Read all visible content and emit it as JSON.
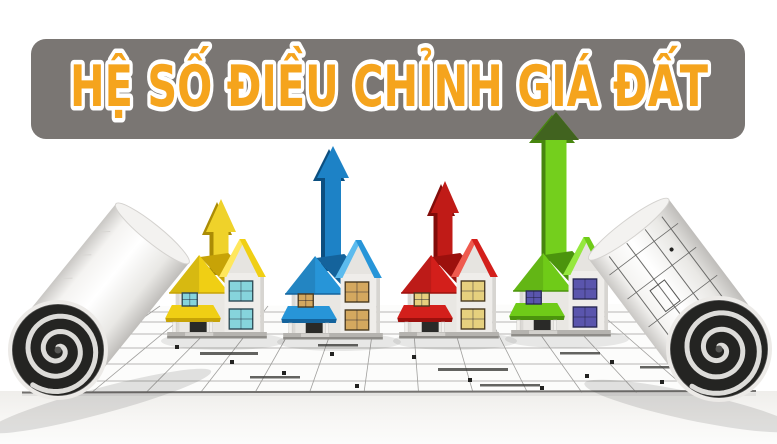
{
  "banner": {
    "title": "HỆ SỐ ĐIỀU CHỈNH GIÁ ĐẤT",
    "bg_color": "#7a7673",
    "title_color": "#f5a41d",
    "title_outline_color": "#ffffff",
    "x": 31,
    "y": 39,
    "width": 714,
    "height": 100,
    "radius": 15,
    "text_center_x": 389,
    "text_baseline_y": 106,
    "font_size": 57,
    "text_length": 638
  },
  "illustration": {
    "palette": {
      "wall": "#e9e7e3",
      "wall_right": "#efedea",
      "wall_gable": "#e6e4e0",
      "wall_side": "#d7d5d1",
      "door": "#2a2a28",
      "post": "#f2f0ed",
      "base_top": "#b5b3af",
      "base_edge": "#8e8c88",
      "step": "#d2d0cc",
      "plan_line": "#a09f9d",
      "plan_dark": "#3c3c3a",
      "paper_edge": "#757371",
      "roll_face": "#242422",
      "roll_spiral": "#dddcd9",
      "roll_rim": "#eceae7",
      "ground_top": "#efeeeb",
      "ground_bottom": "#fcfcfb"
    },
    "floor": {
      "back_y": 306,
      "front_y": 392.5,
      "back_x1": 150,
      "back_x2": 635,
      "front_x1": 22,
      "front_x2": 756,
      "v_lines_from": 160,
      "v_lines_to": 632,
      "v_lines_step": 36,
      "h_lines": [
        312,
        322,
        334,
        348,
        364,
        381
      ],
      "wall_segments": [
        [
          200,
          352,
          58,
          3
        ],
        [
          318,
          344,
          40,
          2.5
        ],
        [
          438,
          368,
          70,
          3
        ],
        [
          560,
          352,
          40,
          2.5
        ],
        [
          250,
          376,
          50,
          2.5
        ],
        [
          480,
          384,
          60,
          2.5
        ],
        [
          640,
          366,
          45,
          2.5
        ]
      ],
      "dots": [
        [
          230,
          360
        ],
        [
          282,
          371
        ],
        [
          355,
          384
        ],
        [
          412,
          355
        ],
        [
          468,
          378
        ],
        [
          540,
          386
        ],
        [
          610,
          360
        ],
        [
          660,
          380
        ],
        [
          175,
          345
        ],
        [
          700,
          371
        ],
        [
          330,
          352
        ],
        [
          585,
          374
        ]
      ]
    },
    "houses": [
      {
        "id": "yellow",
        "x": 170,
        "base_y": 339,
        "w": 94,
        "roof": "#f0cf14",
        "roof_dark": "#c7a307",
        "roof_light": "#ffe75c",
        "window": "#86d4dc",
        "window_frame": "#2e4a55",
        "arrow": {
          "cx": 221,
          "tip_y": 199,
          "head_w": 30,
          "head_h": 33,
          "shaft_w": 15,
          "base_y": 272,
          "fill": "#efd22a",
          "side": "#ab8c05",
          "head_fill": ""
        }
      },
      {
        "id": "blue",
        "x": 286,
        "base_y": 340,
        "w": 94,
        "roof": "#2795d8",
        "roof_dark": "#14639c",
        "roof_light": "#5cbbee",
        "window": "#d4a85f",
        "window_frame": "#4a3a20",
        "arrow": {
          "cx": 333,
          "tip_y": 146,
          "head_w": 32,
          "head_h": 32,
          "shaft_w": 16,
          "base_y": 268,
          "fill": "#1d82c6",
          "side": "#0c4f80",
          "head_fill": ""
        }
      },
      {
        "id": "red",
        "x": 402,
        "base_y": 339,
        "w": 94,
        "roof": "#d31f1b",
        "roof_dark": "#9c100d",
        "roof_light": "#ef5a4e",
        "window": "#e6d07e",
        "window_frame": "#4a3a20",
        "arrow": {
          "cx": 445,
          "tip_y": 181,
          "head_w": 28,
          "head_h": 32,
          "shaft_w": 15,
          "base_y": 262,
          "fill": "#c01b17",
          "side": "#820c0a",
          "head_fill": ""
        }
      },
      {
        "id": "green",
        "x": 514,
        "base_y": 337,
        "w": 94,
        "roof": "#6fcb18",
        "roof_dark": "#4b940d",
        "roof_light": "#95e83f",
        "window": "#5a55ad",
        "window_frame": "#2a2a55",
        "arrow": {
          "cx": 556,
          "tip_y": 112,
          "head_w": 46,
          "head_h": 28,
          "shaft_w": 21,
          "base_y": 258,
          "fill": "#74cf1d",
          "side": "#47860e",
          "head_fill": "#41631f"
        }
      }
    ],
    "rolls": {
      "left": {
        "face_cx": 58,
        "face_cy": 350,
        "r": 46,
        "rim_r": 50,
        "angle": -51,
        "length": 150,
        "has_plan_lines": false,
        "shadow": {
          "cx": 100,
          "cy": 401,
          "rx": 115,
          "ry": 13,
          "rot": -15
        }
      },
      "right": {
        "face_cx": 719,
        "face_cy": 349,
        "r": 49,
        "rim_r": 53,
        "angle": -127,
        "length": 150,
        "has_plan_lines": true,
        "shadow": {
          "cx": 690,
          "cy": 406,
          "rx": 108,
          "ry": 14,
          "rot": 12
        }
      }
    }
  }
}
